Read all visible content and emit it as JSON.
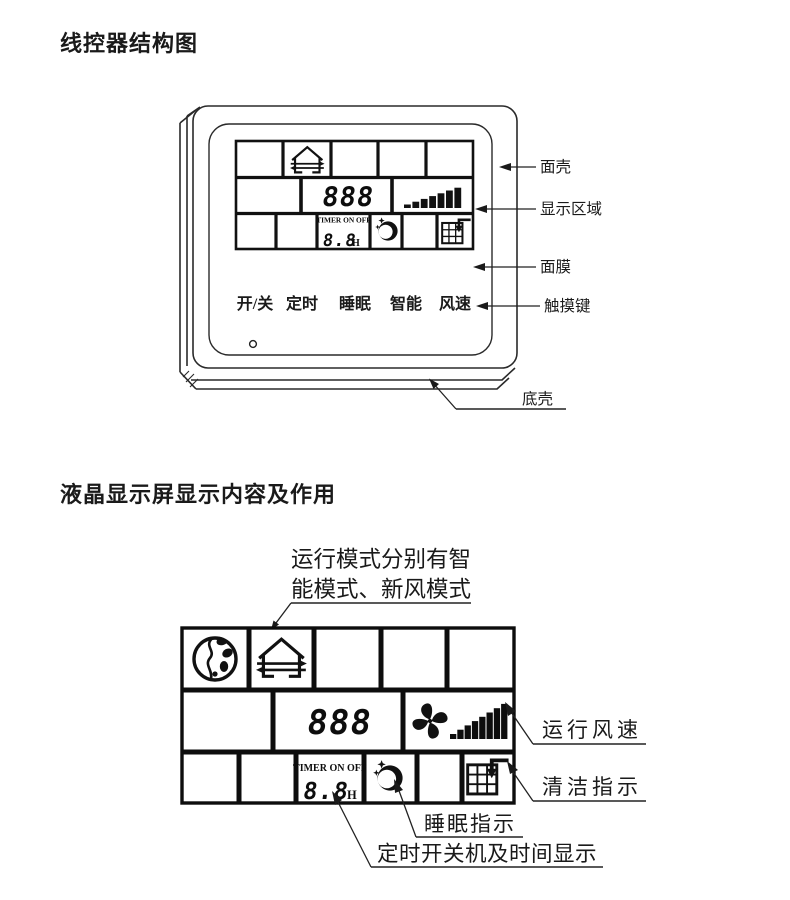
{
  "page": {
    "background": "#ffffff",
    "ink": "#1a1a1a"
  },
  "section1": {
    "title": "线控器结构图",
    "lcd": {
      "temp_value": "888",
      "timer_label": "TIMER ON OFF",
      "timer_value": "8.8",
      "timer_unit": "H",
      "icons": [
        "fresh-air-house-icon",
        "fan-speed-bars-icon",
        "sleep-moon-icon",
        "clean-indicator-icon"
      ]
    },
    "touch_keys": [
      "开/关",
      "定时",
      "睡眠",
      "智能",
      "风速"
    ],
    "indicator": "power-indicator-dot",
    "callouts": {
      "front_shell": "面壳",
      "display_area": "显示区域",
      "face_film": "面膜",
      "touch_key": "触摸键",
      "bottom_shell": "底壳"
    }
  },
  "section2": {
    "title": "液晶显示屏显示内容及作用",
    "mode_note": {
      "line1": "运行模式分别有智",
      "line2": "能模式、新风模式"
    },
    "lcd": {
      "temp_value": "888",
      "timer_label": "TIMER ON OFF",
      "timer_value": "8.8",
      "timer_unit": "H",
      "icons": [
        "globe-icon",
        "fresh-air-house-icon",
        "fan-blades-icon",
        "fan-speed-bars-icon",
        "sleep-moon-icon",
        "clean-indicator-icon"
      ]
    },
    "callouts": {
      "fan_speed": "运行风速",
      "clean": "清洁指示",
      "sleep": "睡眠指示",
      "timer": "定时开关机及时间显示"
    }
  }
}
